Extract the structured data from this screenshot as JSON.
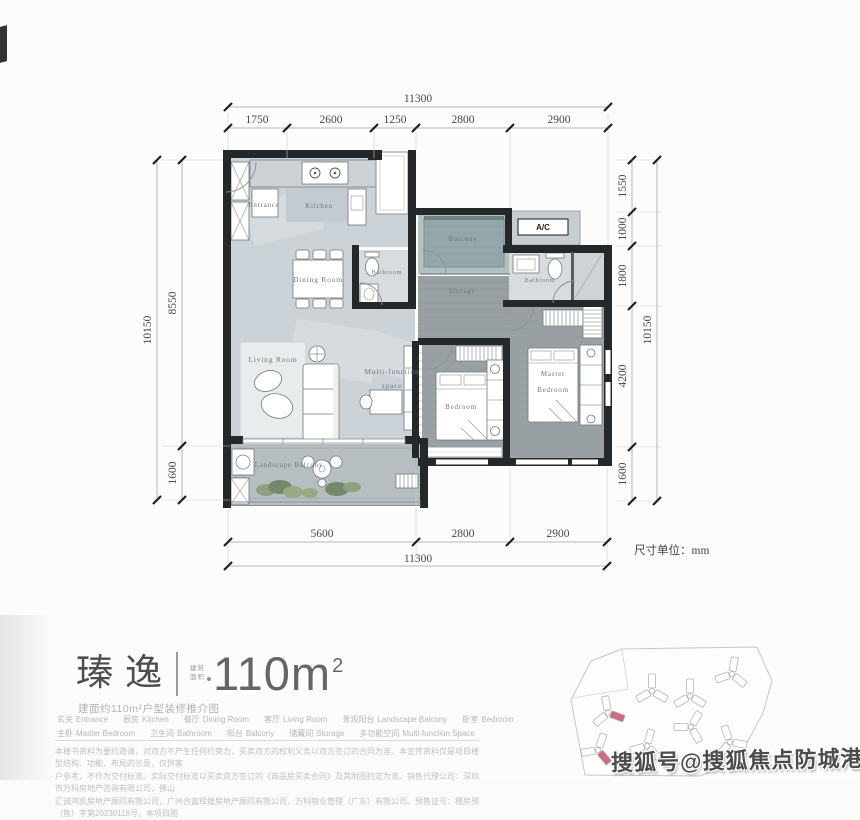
{
  "watermark": "搜狐号@搜狐焦点防城港站",
  "plan": {
    "unit_note": "尺寸单位：mm",
    "rooms": {
      "entrance": "Entrance",
      "kitchen": "Kitchen",
      "dining_room": "Dining Room",
      "bathroom_1": "Bathroom",
      "bathroom_2": "Bathroom",
      "balcony": "Balcony",
      "ac": "A/C",
      "storage": "Storage",
      "living_room": "Living Room",
      "multi_function_1": "Multi-function",
      "multi_function_2": "space",
      "bedroom": "Bedroom",
      "master_1": "Master",
      "master_2": "Bedroom",
      "landscape_balcony": "Landscape Balcony"
    },
    "dims": {
      "top_total": "11300",
      "top_segments": [
        "1750",
        "2600",
        "1250",
        "2800",
        "2900"
      ],
      "bottom_segments": [
        "5600",
        "2800",
        "2900"
      ],
      "bottom_total": "11300",
      "left_total": "10150",
      "left_segments": [
        "8550",
        "1600"
      ],
      "right_total": "10150",
      "right_segments": [
        "1550",
        "1000",
        "1800",
        "4200",
        "1600"
      ]
    }
  },
  "title": {
    "name": "瑧逸",
    "badge_line1": "建筑",
    "badge_line2": "面积",
    "area_value": "110m",
    "area_sup": "2",
    "subtitle": "建面约110m²户型装修推介图"
  },
  "legend": {
    "row1": [
      {
        "cn": "玄关",
        "en": "Entrance"
      },
      {
        "cn": "厨房",
        "en": "Kitchen"
      },
      {
        "cn": "餐厅",
        "en": "Dining Room"
      },
      {
        "cn": "客厅",
        "en": "Living Room"
      },
      {
        "cn": "景观阳台",
        "en": "Landscape Balcony"
      },
      {
        "cn": "卧室",
        "en": "Bedroom"
      }
    ],
    "row2": [
      {
        "cn": "主卧",
        "en": "Master Bedroom"
      },
      {
        "cn": "卫生间",
        "en": "Bathroom"
      },
      {
        "cn": "阳台",
        "en": "Balcony"
      },
      {
        "cn": "储藏间",
        "en": "Storage"
      },
      {
        "cn": "多功能空间",
        "en": "Multi-function Space"
      }
    ]
  },
  "disclaimer": {
    "line1": "本楼书资料为要约邀请，对双方不产生任何约束力，买卖双方的权利义务以双方签订的合同为准。本宣传资料仅是项目楼型结构、功能、布局的示意，仅供客",
    "line2": "户参考，不作为交付标准。实际交付标准以买卖双方签订的《商品房买卖合同》及其附图约定为准。销售代理公司：深圳市万科房地产咨询有限公司，佛山",
    "line3": "汇诚鸿凯房地产顾问有限公司，广州合富辉煌房地产顾问有限公司，万科物业管理（广东）有限公司。预售证号：穗房预（售）字第20230118号。本项目图"
  }
}
